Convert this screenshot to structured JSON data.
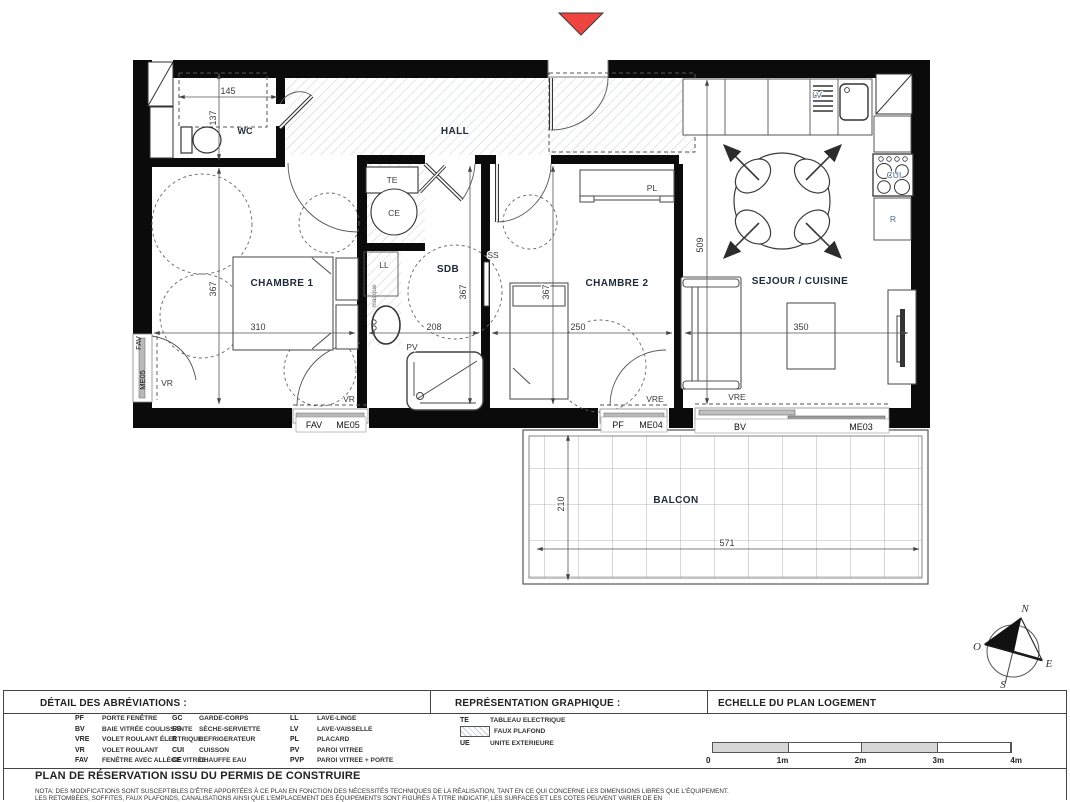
{
  "colors": {
    "entrance_marker": "#ef4540",
    "wall": "#0b0b0b",
    "equipment_blue": "#4a6d91"
  },
  "labels": {
    "hall": "HALL",
    "wc": "WC",
    "chambre1": "CHAMBRE 1",
    "sdb": "SDB",
    "chambre2": "CHAMBRE 2",
    "sejour": "SEJOUR / CUISINE",
    "balcon": "BALCON",
    "te": "TE",
    "ce": "CE",
    "ll": "LL",
    "ss": "SS",
    "pv": "PV",
    "pl": "PL",
    "lv": "LV",
    "cui": "CUI",
    "r": "R",
    "vr": "VR",
    "vre": "VRE",
    "bv": "BV",
    "pf": "PF",
    "fav": "FAV",
    "me03": "ME03",
    "me04": "ME04",
    "me05": "ME05",
    "masque": "masque"
  },
  "dims": {
    "wc_w": "145",
    "wc_h": "137",
    "ch1_h": "367",
    "ch1_w": "310",
    "sdb_h": "367",
    "sdb_w": "208",
    "ch2_h": "367",
    "ch2_w": "250",
    "sej_h": "509",
    "sej_w": "350",
    "bal_h": "210",
    "bal_w": "571"
  },
  "compass": {
    "n": "N",
    "s": "S",
    "e": "E",
    "o": "O"
  },
  "legend": {
    "sections": {
      "abbreviations_title": "DÉTAIL DES ABRÉVIATIONS :",
      "representation_title": "REPRÉSENTATION GRAPHIQUE :",
      "scale_title": "ECHELLE DU PLAN LOGEMENT"
    },
    "abbreviations": {
      "col1": [
        {
          "abbr": "PF",
          "label": "PORTE FENÊTRE"
        },
        {
          "abbr": "BV",
          "label": "BAIE VITRÉE COULISSANTE"
        },
        {
          "abbr": "VRE",
          "label": "VOLET ROULANT ÉLECTRIQUE"
        },
        {
          "abbr": "VR",
          "label": "VOLET ROULANT"
        },
        {
          "abbr": "FAV",
          "label": "FENÊTRE AVEC ALLÈGE VITRÉE"
        }
      ],
      "col2": [
        {
          "abbr": "GC",
          "label": "GARDE-CORPS"
        },
        {
          "abbr": "SS",
          "label": "SÈCHE-SERVIETTE"
        },
        {
          "abbr": "R",
          "label": "REFRIGERATEUR"
        },
        {
          "abbr": "CUI",
          "label": "CUISSON"
        },
        {
          "abbr": "CE",
          "label": "CHAUFFE EAU"
        }
      ],
      "col3": [
        {
          "abbr": "LL",
          "label": "LAVE-LINGE"
        },
        {
          "abbr": "LV",
          "label": "LAVE-VAISSELLE"
        },
        {
          "abbr": "PL",
          "label": "PLACARD"
        },
        {
          "abbr": "PV",
          "label": "PAROI VITREE"
        },
        {
          "abbr": "PVP",
          "label": "PAROI VITREE + PORTE"
        }
      ]
    },
    "representation": {
      "te_abbr": "TE",
      "te_label": "TABLEAU ELECTRIQUE",
      "faux_plafond_label": "FAUX PLAFOND",
      "ue_abbr": "UE",
      "ue_label": "UNITE EXTERIEURE"
    },
    "scale": {
      "labels": [
        "0",
        "1m",
        "2m",
        "3m",
        "4m"
      ]
    },
    "title": "PLAN DE RÉSERVATION ISSU DU PERMIS DE CONSTRUIRE",
    "nota1": "NOTA: DES MODIFICATIONS SONT SUSCEPTIBLES D'ÊTRE APPORTÉES À CE PLAN EN FONCTION DES NÉCESSITÉS TECHNIQUES DE LA RÉALISATION, TANT EN CE QUI CONCERNE LES DIMENSIONS LIBRES QUE L'ÉQUIPEMENT.",
    "nota2": "LES RETOMBÉES, SOFFITES, FAUX PLAFONDS, CANALISATIONS AINSI QUE L'EMPLACEMENT DES ÉQUIPEMENTS SONT FIGURÉS À TITRE INDICATIF, LES SURFACES ET LES COTES PEUVENT VARIER DE EN"
  }
}
